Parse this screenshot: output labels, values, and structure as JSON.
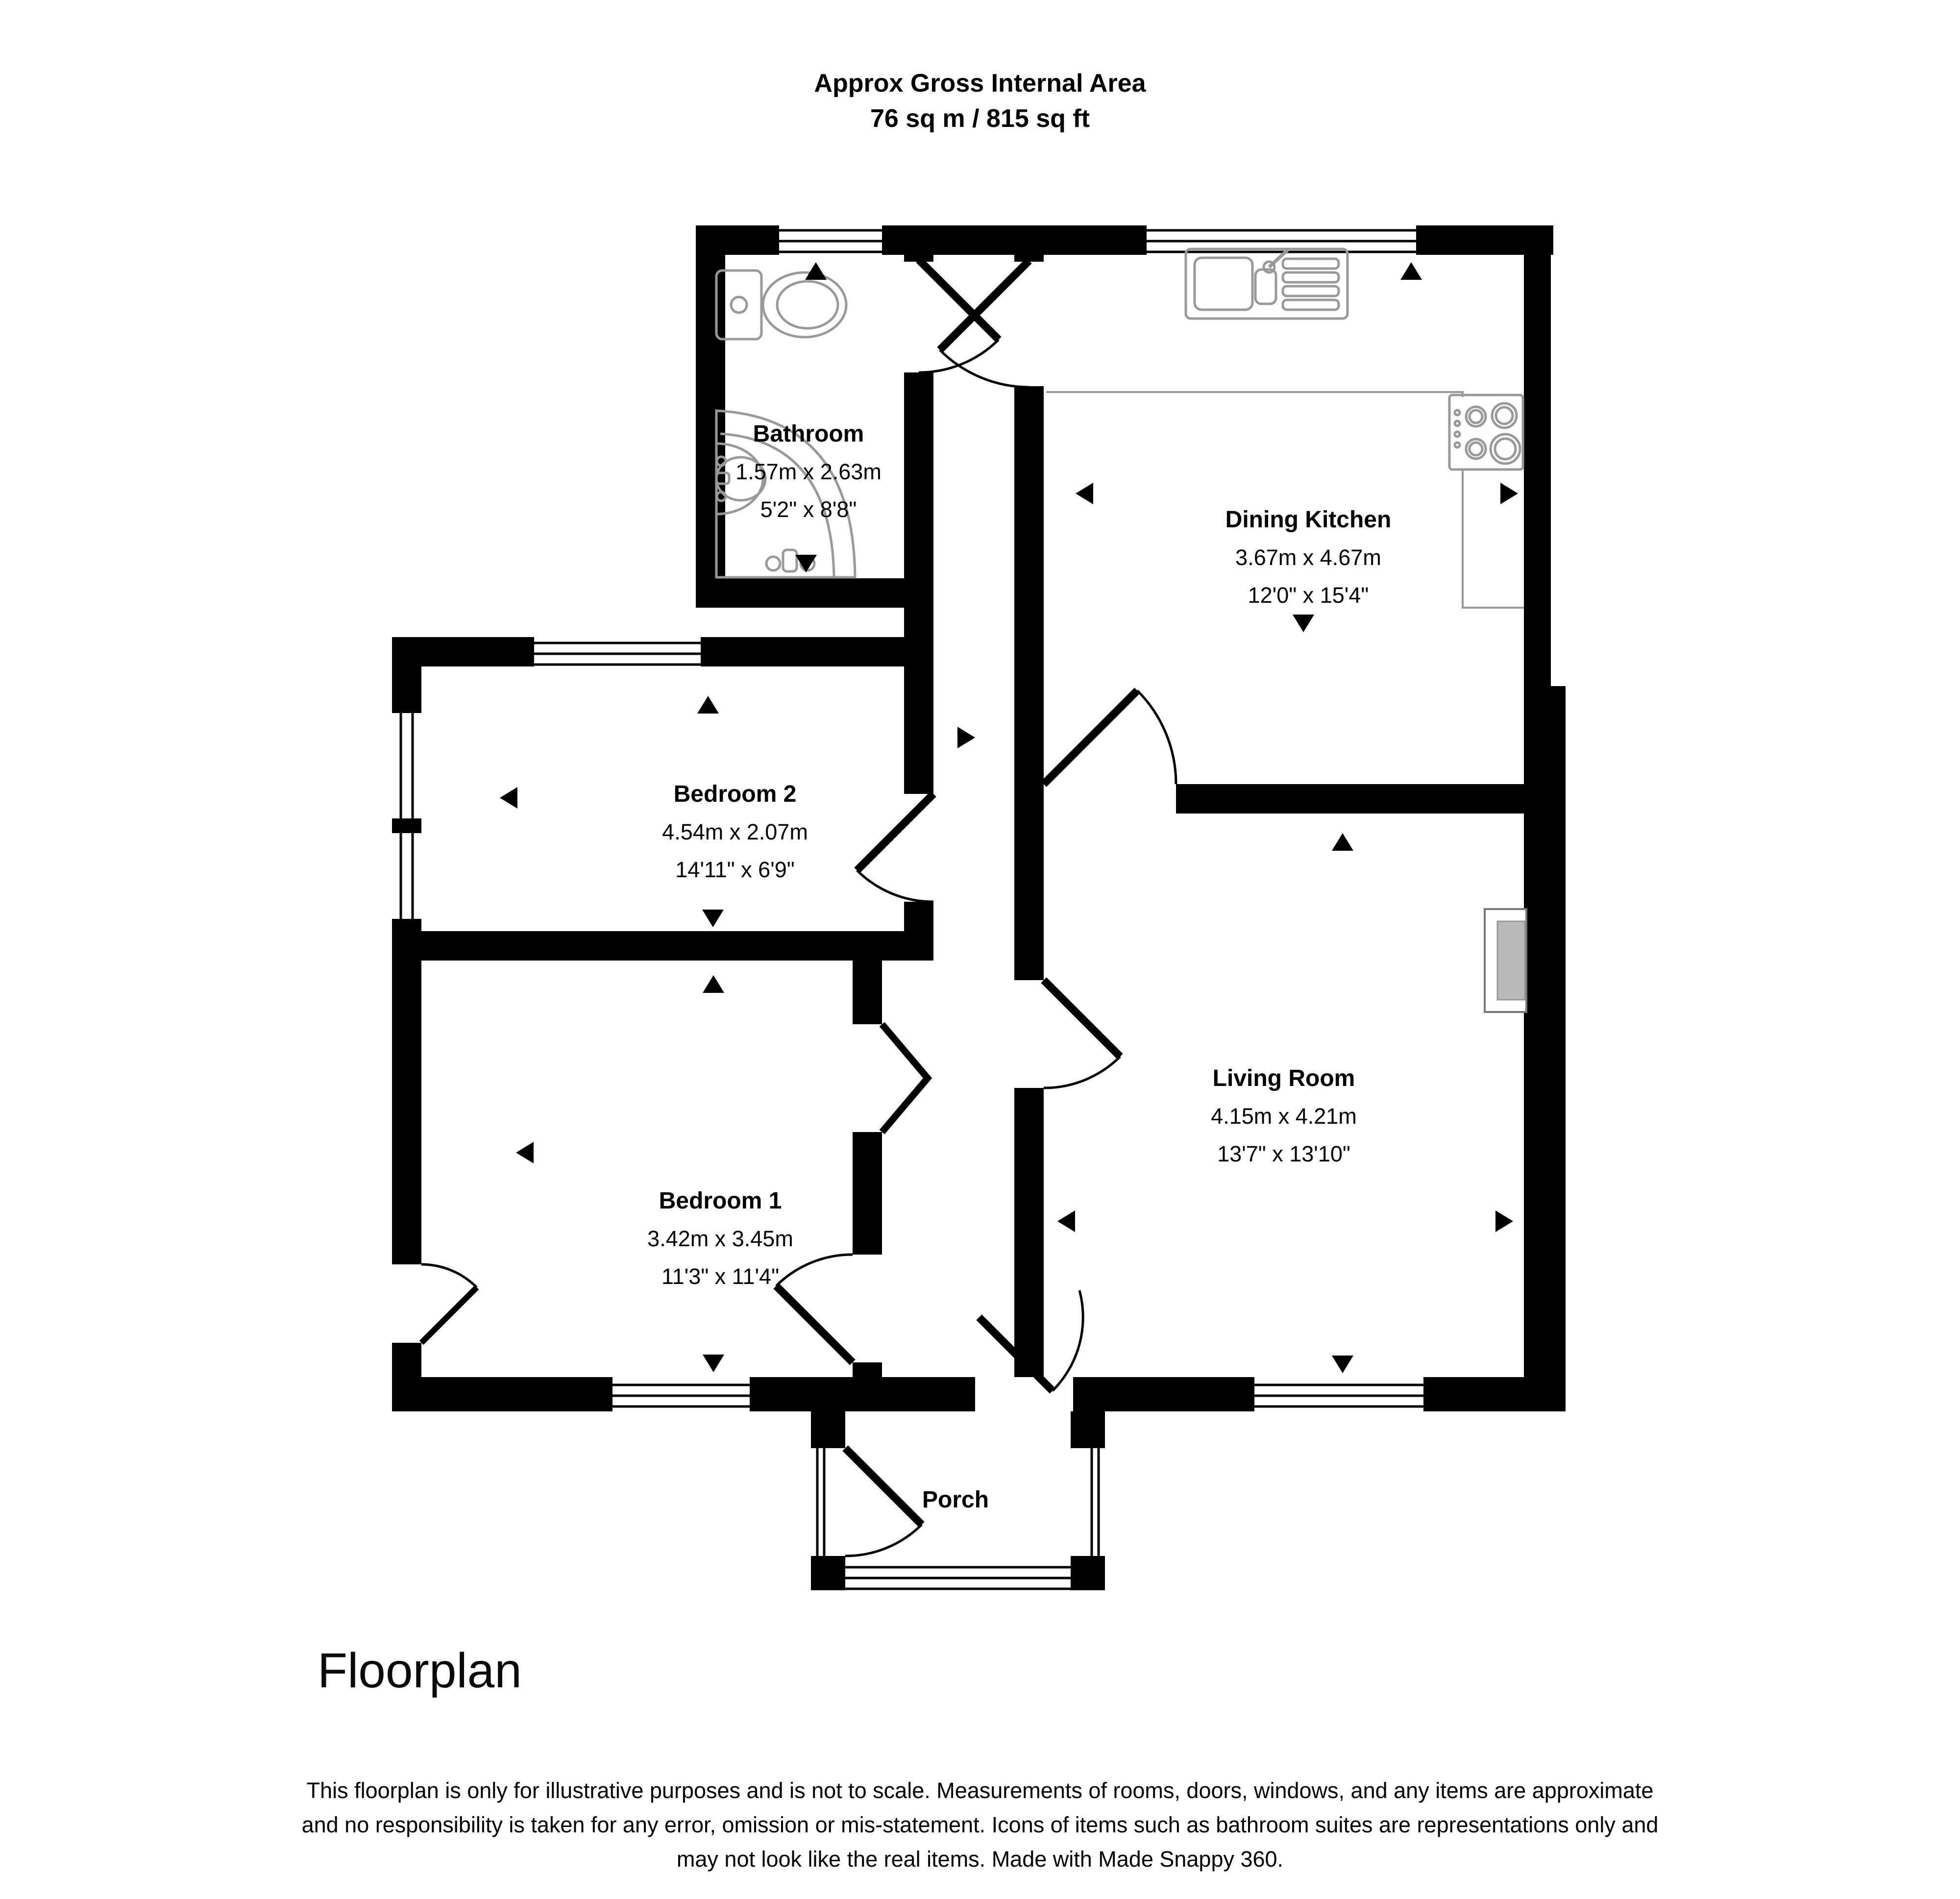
{
  "header": {
    "title_line1": "Approx Gross Internal Area",
    "title_line2": "76 sq m / 815 sq ft"
  },
  "rooms": [
    {
      "name": "Bathroom",
      "metric": "1.57m x 2.63m",
      "imperial": "5'2\" x 8'8\""
    },
    {
      "name": "Dining Kitchen",
      "metric": "3.67m x 4.67m",
      "imperial": "12'0\" x 15'4\""
    },
    {
      "name": "Bedroom 2",
      "metric": "4.54m x 2.07m",
      "imperial": "14'11\" x 6'9\""
    },
    {
      "name": "Bedroom 1",
      "metric": "3.42m x 3.45m",
      "imperial": "11'3\" x 11'4\""
    },
    {
      "name": "Living Room",
      "metric": "4.15m x 4.21m",
      "imperial": "13'7\" x 13'10\""
    },
    {
      "name": "Porch",
      "metric": "",
      "imperial": ""
    }
  ],
  "footer": {
    "caption": "Floorplan",
    "disclaimer_line1": "This floorplan is only for illustrative purposes and is not to scale. Measurements of rooms, doors, windows, and any items are approximate",
    "disclaimer_line2": "and no responsibility is taken for any error, omission or mis-statement. Icons of items such as bathroom suites are representations only and",
    "disclaimer_line3": "may not look like the real items. Made with Made Snappy 360."
  },
  "colors": {
    "wall": "#000000",
    "fixture_outline": "#999999",
    "fireplace_fill": "#b9b9b9"
  }
}
